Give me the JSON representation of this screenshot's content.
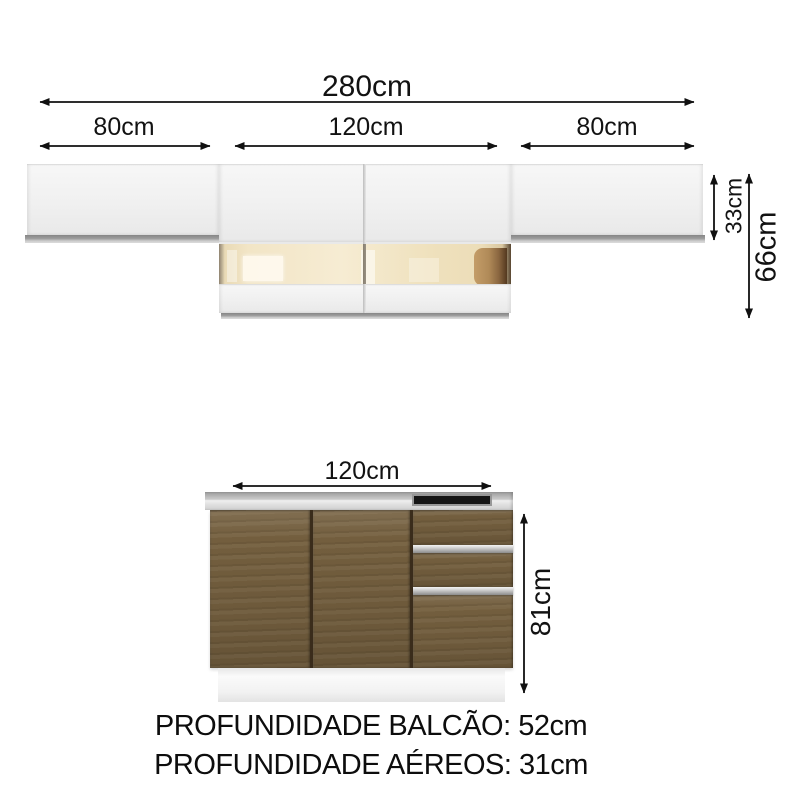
{
  "labels": {
    "wall_total_width": "280cm",
    "wall_left_width": "80cm",
    "wall_middle_width": "120cm",
    "wall_right_width": "80cm",
    "wall_door_height": "33cm",
    "wall_total_height": "66cm",
    "base_width": "120cm",
    "base_height": "81cm"
  },
  "footer": {
    "balcao_depth": "PROFUNDIDADE BALCÃO: 52cm",
    "aereos_depth": "PROFUNDIDADE AÉREOS: 31cm"
  },
  "colors": {
    "arrow": "#111111",
    "cabinet_white": "#f1f1f1",
    "cabinet_trim_gray": "#9d9d9d",
    "glass_interior_cream": "#f2e5c6",
    "wood_brown": "#75603f",
    "countertop_gray": "#c9c9c9",
    "handle_silver": "#c0c0c0",
    "cooktop_black": "#161616"
  }
}
